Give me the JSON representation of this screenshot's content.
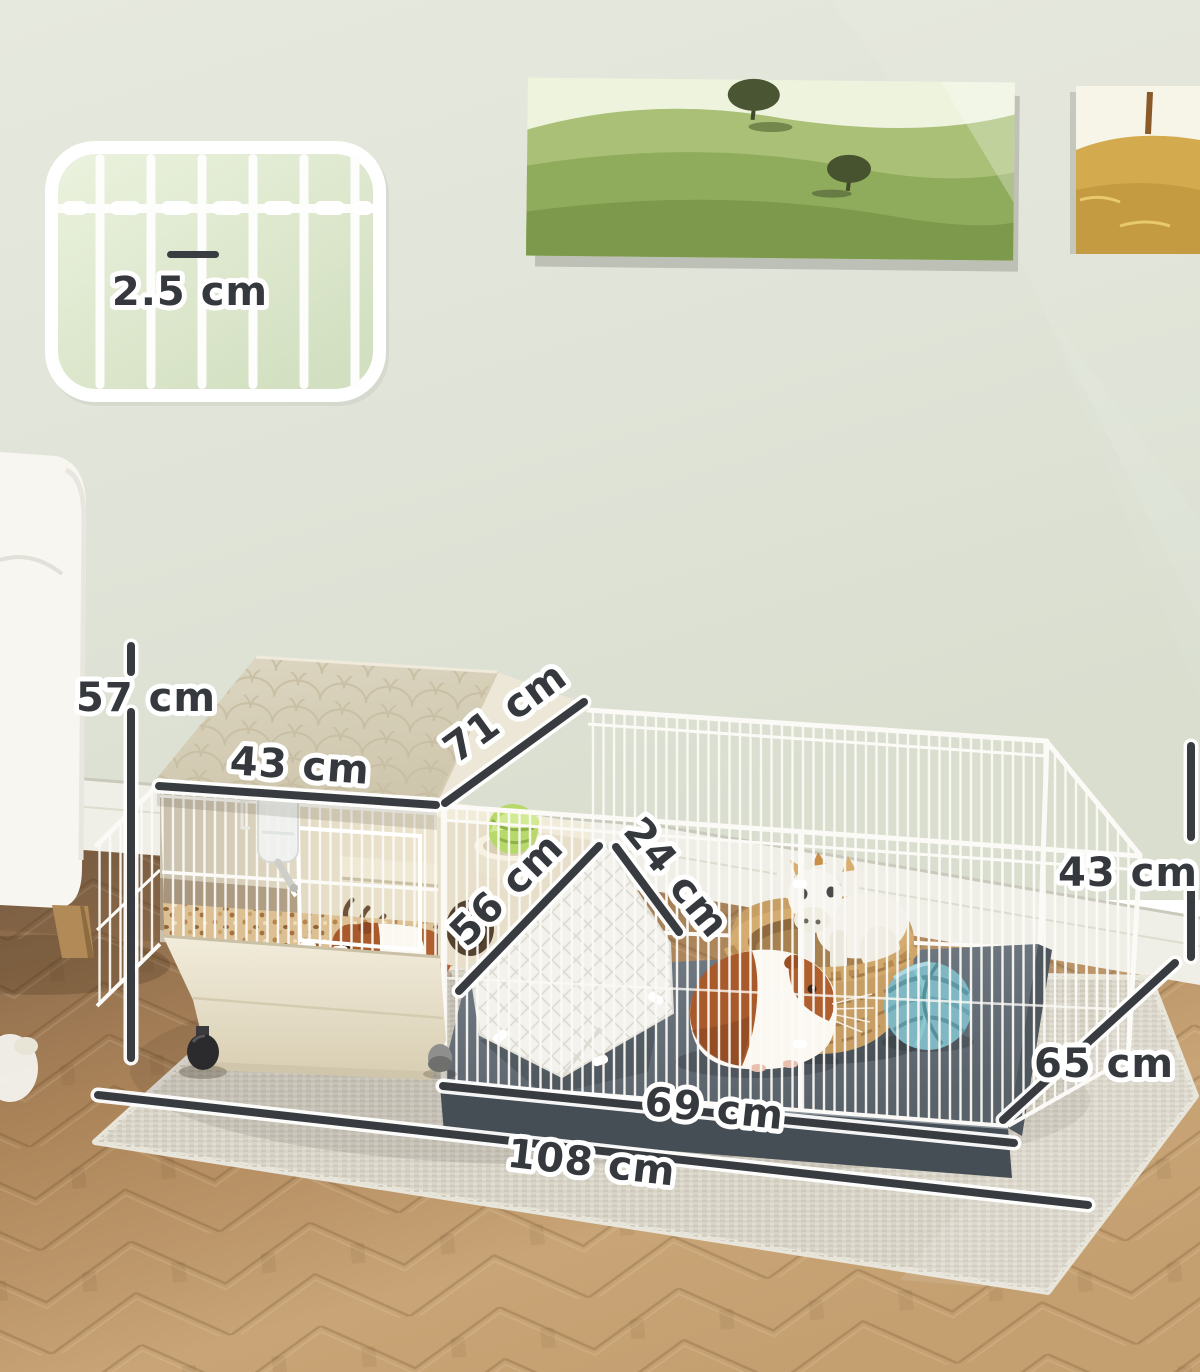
{
  "image_type": "product dimension photo",
  "product": "small animal cage hutch with attached play pen, two guinea pigs",
  "dimension_labels": {
    "total_height": "57 cm",
    "roof_front_edge": "43 cm",
    "roof_slope_depth": "71 cm",
    "ramp_length": "56 cm",
    "ramp_width": "24 cm",
    "pen_wall_height": "43 cm",
    "pen_front_length": "69 cm",
    "overall_length": "108 cm",
    "overall_depth": "65 cm",
    "inset_bar_spacing": "2.5 cm"
  },
  "scene_objects": [
    "wire-bar-spacing-inset",
    "green-hills-painting",
    "golden-field-painting",
    "white-armchair",
    "sage-wall",
    "herringbone-wood-floor",
    "gray-area-rug",
    "cream-hutch-with-scalloped-roof",
    "water-bottle",
    "wood-shavings-bedding",
    "guinea-pig-in-hutch",
    "food-bowl-with-cabbage",
    "fleece-ramp",
    "gray-pen-floor-tray",
    "white-wire-fence",
    "wicker-basket",
    "plush-goat-toy",
    "guinea-pig-in-pen",
    "teal-yarn-ball",
    "caster-wheels"
  ],
  "colors": {
    "wall": "#e0e4d8",
    "baseboard": "#f0efe7",
    "wood_floor": "#b28a5e",
    "rug": "#d8d4c8",
    "roof_cream": "#d9d1ba",
    "tray_cream": "#ece5d1",
    "pen_floor_gray": "#67717b",
    "wire_white": "#fbfaf6",
    "dimension_line": "#383c40",
    "label_text": "#35393d",
    "basket_tan": "#c79e63",
    "yarn_teal": "#7fb7c2",
    "guinea_pig_brown": "#a85a2b",
    "cabbage_green": "#b7d96b",
    "inset_panel_green": "#dde8cc"
  }
}
